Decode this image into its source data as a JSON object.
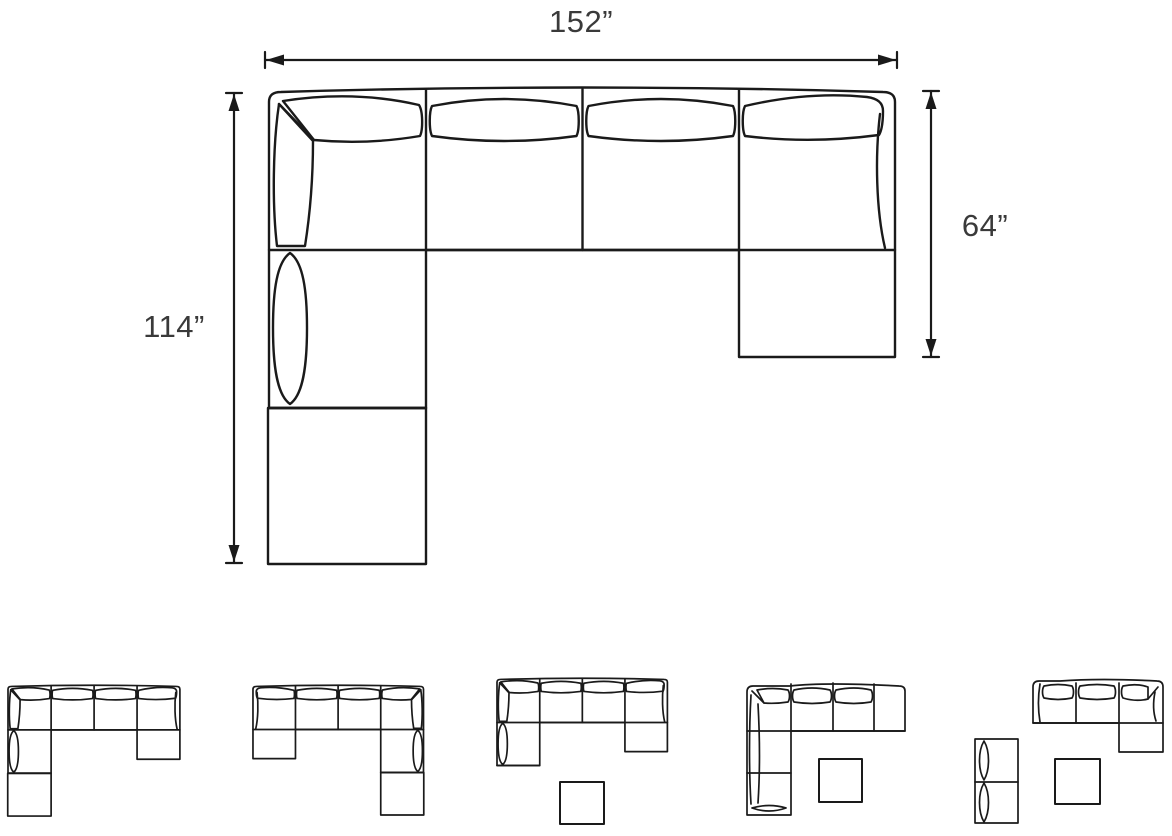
{
  "diagram": {
    "type": "sectional-sofa-dimension-diagram",
    "labels": {
      "overall_width": "152”",
      "left_depth": "114”",
      "right_depth": "64”"
    },
    "colors": {
      "line": "#1a1a1a",
      "label_text": "#3a3a3a",
      "background": "#ffffff"
    },
    "thumbnails": [
      {
        "id": 1,
        "name": "u-sectional-corner-left-chaise-right-attached-ottoman"
      },
      {
        "id": 2,
        "name": "u-sectional-corner-right-chaise-left-attached-ottoman-mirrored"
      },
      {
        "id": 3,
        "name": "u-sectional-with-detached-ottoman"
      },
      {
        "id": 4,
        "name": "l-sectional-corner-left-with-detached-ottoman"
      },
      {
        "id": 5,
        "name": "three-piece-sofa-chaise-loveseat-detached-ottoman"
      }
    ]
  }
}
